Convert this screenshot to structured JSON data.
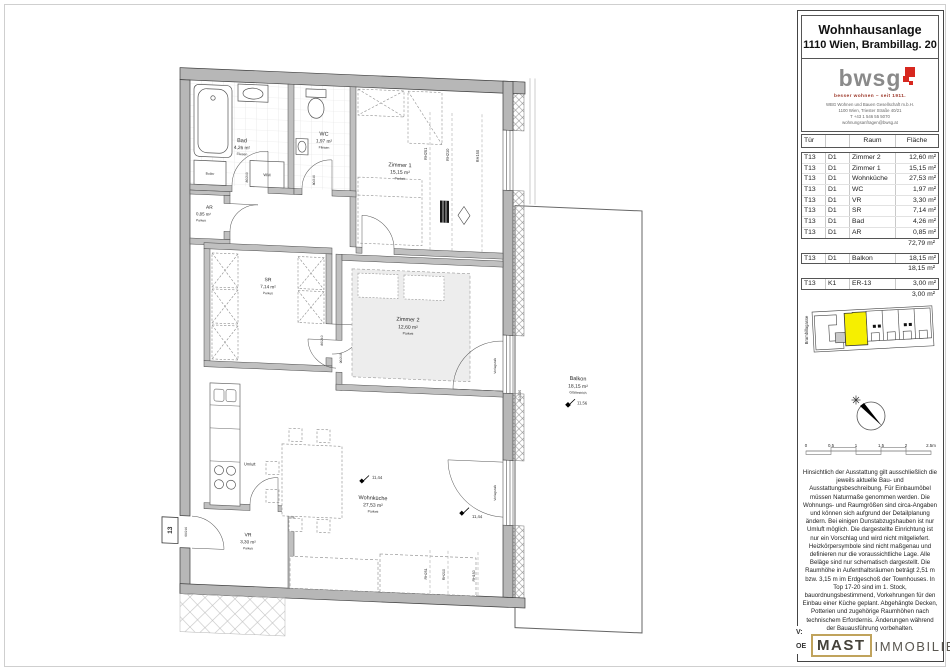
{
  "panel": {
    "title": {
      "line1": "Wohnhausanlage",
      "line2": "1110 Wien, Brambillag. 20"
    },
    "brand": {
      "logo": "bwsg",
      "slogan": "besser wohnen – seit 1911.",
      "addr1": "WBG Wohnen und Bauen Gesellschaft m.b.H.",
      "addr2": "1100 Wien, Triester Straße 40/21",
      "addr3": "T +43 1 546 55 5070",
      "addr4": "wohnungsanfragen@bwsg.at"
    },
    "table": {
      "headers": {
        "tuer": "Tür",
        "raum": "Raum",
        "flaeche": "Fläche"
      },
      "groups": [
        {
          "rows": [
            [
              "T13",
              "D1",
              "Zimmer 2",
              "12,60 m²"
            ],
            [
              "T13",
              "D1",
              "Zimmer 1",
              "15,15 m²"
            ],
            [
              "T13",
              "D1",
              "Wohnküche",
              "27,53 m²"
            ],
            [
              "T13",
              "D1",
              "WC",
              "1,97 m²"
            ],
            [
              "T13",
              "D1",
              "VR",
              "3,30 m²"
            ],
            [
              "T13",
              "D1",
              "SR",
              "7,14 m²"
            ],
            [
              "T13",
              "D1",
              "Bad",
              "4,26 m²"
            ],
            [
              "T13",
              "D1",
              "AR",
              "0,85 m²"
            ]
          ],
          "sum": "72,79 m²"
        },
        {
          "rows": [
            [
              "T13",
              "D1",
              "Balkon",
              "18,15 m²"
            ]
          ],
          "sum": "18,15 m²"
        },
        {
          "rows": [
            [
              "T13",
              "K1",
              "ER-13",
              "3,00 m²"
            ]
          ],
          "sum": "3,00 m²"
        }
      ]
    },
    "site": {
      "street": "Brambillagasse",
      "highlight_color": "#f6ef00"
    },
    "scale": {
      "labels": [
        "0",
        "0.5",
        "1",
        "1.5",
        "2",
        "2.5m"
      ]
    },
    "disclaimer": "Hinsichtlich der Ausstattung gilt ausschließlich die jeweils aktuelle Bau- und Ausstattungsbeschreibung. Für Einbaumöbel müssen Naturmaße genommen werden. Die Wohnungs- und Raumgrößen sind circa-Angaben und können sich aufgrund der Detailplanung ändern. Bei einigen Dunstabzugshauben ist nur Umluft möglich. Die dargestellte Einrichtung ist nur ein Vorschlag und wird nicht mitgeliefert. Heizkörpersymbole sind nicht maßgenau und definieren nur die voraussichtliche Lage. Alle Beläge sind nur schematisch dargestellt. Die Raumhöhe in Aufenthaltsräumen beträgt 2,51 m bzw. 3,15 m im Erdgeschoß der Townhouses. In Top 17-20 sind im 1. Stock, bauordnungsbestimmend, Vorkehrungen für den Einbau einer Küche geplant. Abgehängte Decken, Potterien und zugehörige Raumhöhen nach technischem Erfordernis. Änderungen während der Bauausführung vorbehalten.",
    "footer": {
      "v": "V:",
      "oe": "OE"
    },
    "mast": {
      "word1": "MAST",
      "word2": "IMMOBILIEN"
    }
  },
  "plan": {
    "rooms": {
      "bad": {
        "name": "Bad",
        "area": "4,26 m²",
        "floor": "Fliesen"
      },
      "wc": {
        "name": "WC",
        "area": "1,97 m²",
        "floor": "Fliesen"
      },
      "zimmer1": {
        "name": "Zimmer 1",
        "area": "15,15 m²",
        "floor": "Parkett"
      },
      "ar": {
        "name": "AR",
        "area": "0,85 m²",
        "floor": "Parkett"
      },
      "sr": {
        "name": "SR",
        "area": "7,14 m²",
        "floor": "Parkett"
      },
      "zimmer2": {
        "name": "Zimmer 2",
        "area": "12,60 m²",
        "floor": "Parkett"
      },
      "wohnkueche": {
        "name": "Wohnküche",
        "area": "27,53 m²",
        "floor": "Parkett"
      },
      "vr": {
        "name": "VR",
        "area": "3,30 m²",
        "floor": "Parkett"
      },
      "balkon": {
        "name": "Balkon",
        "area": "18,15 m²",
        "floor": "Glättestrich"
      }
    },
    "ann": {
      "wm": "WM",
      "boiler": "Boiler",
      "umluft": "Umluft",
      "vorlegstufe": "Vorlegstufe",
      "rh251": "RH251",
      "rh210": "RH210",
      "rh150": "RH150",
      "elev_a": "11,44",
      "elev_b": "11,44",
      "elev_balkon": "11,56",
      "dim_bad": "80/210",
      "dim_wc": "80/210",
      "dim_sr": "80/210",
      "dim_z2": "90/210",
      "dim_entry": "99/210",
      "dim_balkontuer": "110/235",
      "entry": "13"
    }
  }
}
